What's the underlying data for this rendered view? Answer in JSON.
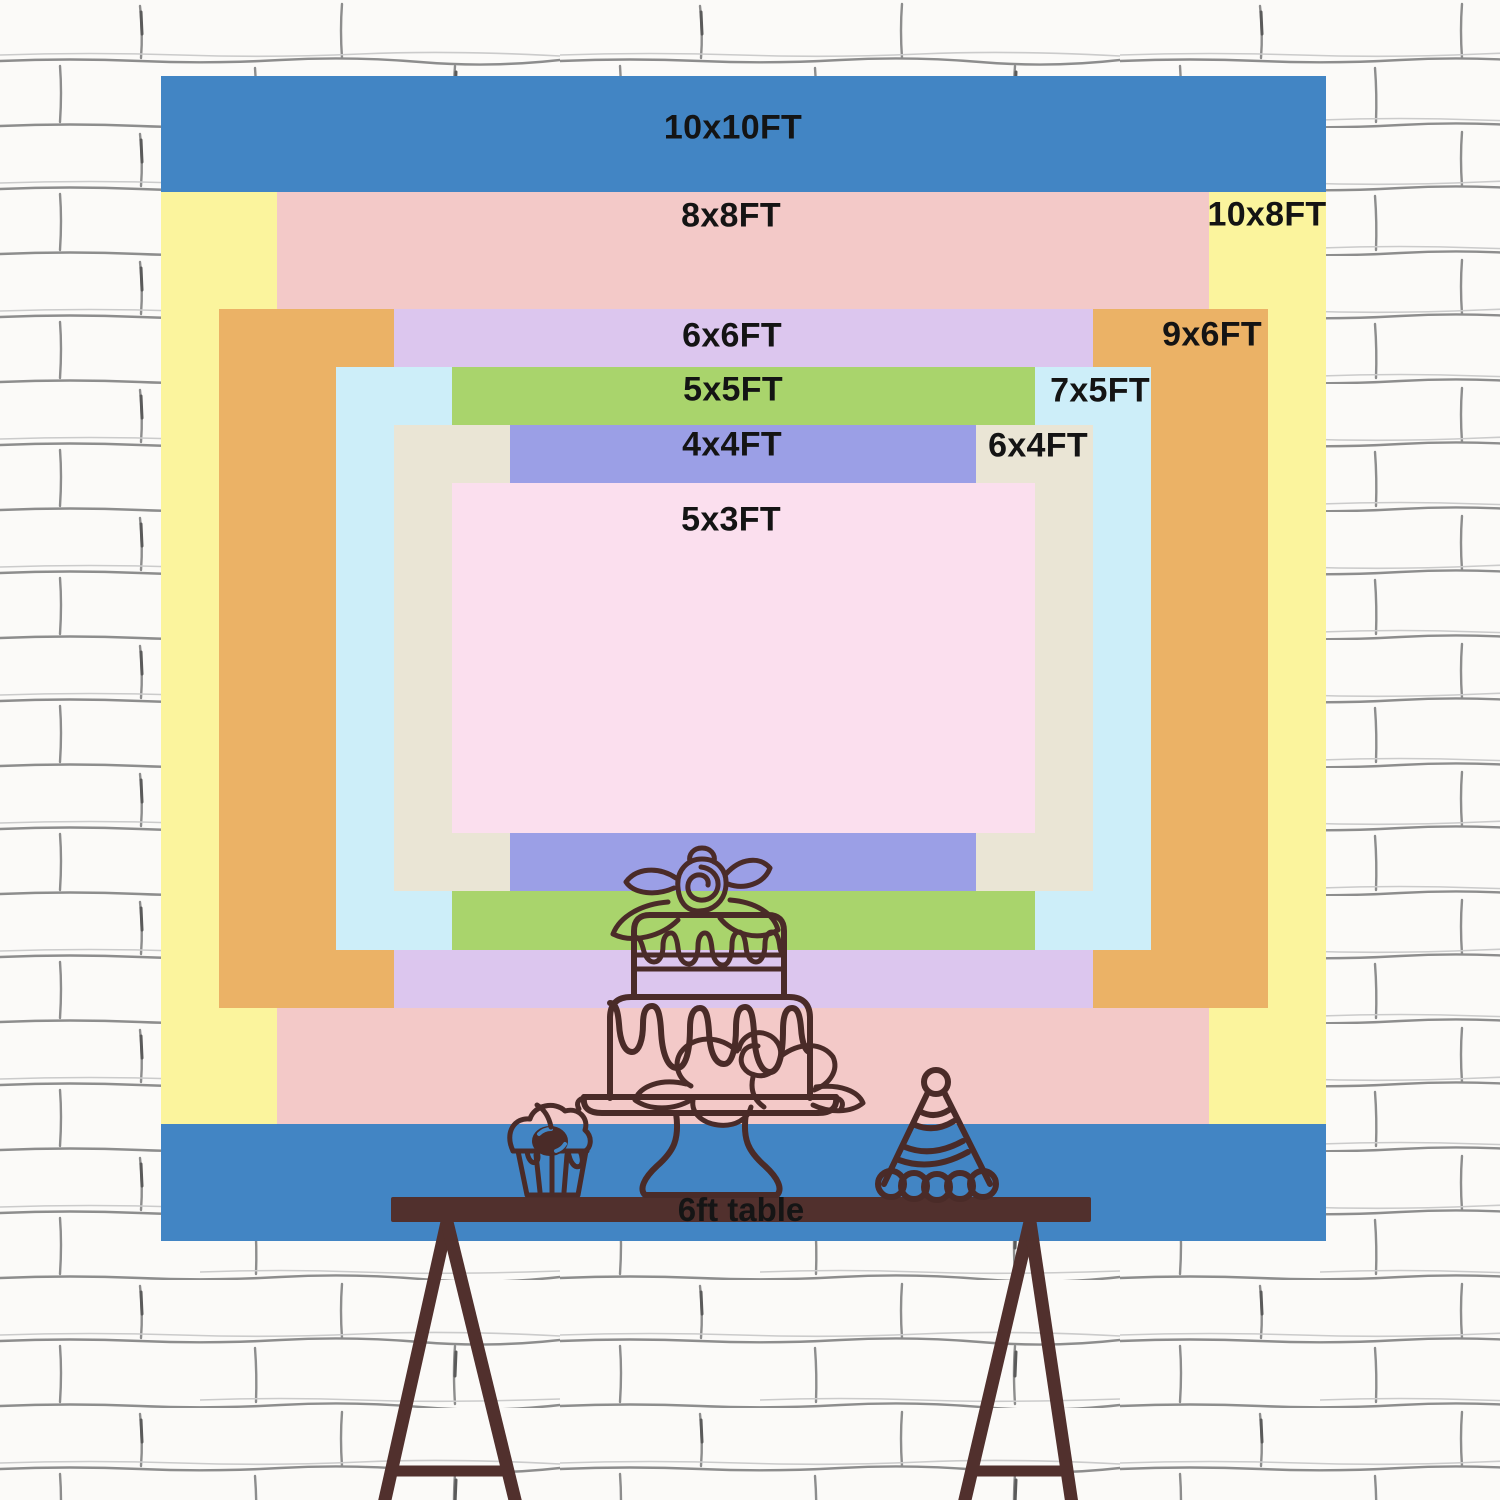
{
  "sizes": [
    {
      "label": "10x10FT",
      "width_ft": 10,
      "height_ft": 10,
      "color": "#4285c4"
    },
    {
      "label": "10x8FT",
      "width_ft": 10,
      "height_ft": 8,
      "color": "#fbf49d"
    },
    {
      "label": "8x8FT",
      "width_ft": 8,
      "height_ft": 8,
      "color": "#f3c9c8"
    },
    {
      "label": "9x6FT",
      "width_ft": 9,
      "height_ft": 6,
      "color": "#ebb266"
    },
    {
      "label": "6x6FT",
      "width_ft": 6,
      "height_ft": 6,
      "color": "#dcc6ee"
    },
    {
      "label": "7x5FT",
      "width_ft": 7,
      "height_ft": 5,
      "color": "#cdeef9"
    },
    {
      "label": "5x5FT",
      "width_ft": 5,
      "height_ft": 5,
      "color": "#a9d46c"
    },
    {
      "label": "6x4FT",
      "width_ft": 6,
      "height_ft": 4,
      "color": "#eae5d5"
    },
    {
      "label": "4x4FT",
      "width_ft": 4,
      "height_ft": 4,
      "color": "#9b9fe6"
    },
    {
      "label": "5x3FT",
      "width_ft": 5,
      "height_ft": 3,
      "color": "#fbdfee"
    }
  ],
  "table": {
    "label": "6ft table",
    "color": "#51302d"
  },
  "illustrations": {
    "cake": "cake-icon",
    "cupcake": "cupcake-icon",
    "party_hat": "party-hat-icon"
  },
  "colors": {
    "ink": "#4a2b28",
    "label_text": "#141414",
    "wall_background": "#fbfaf8",
    "wall_line": "#8d8d8d"
  }
}
